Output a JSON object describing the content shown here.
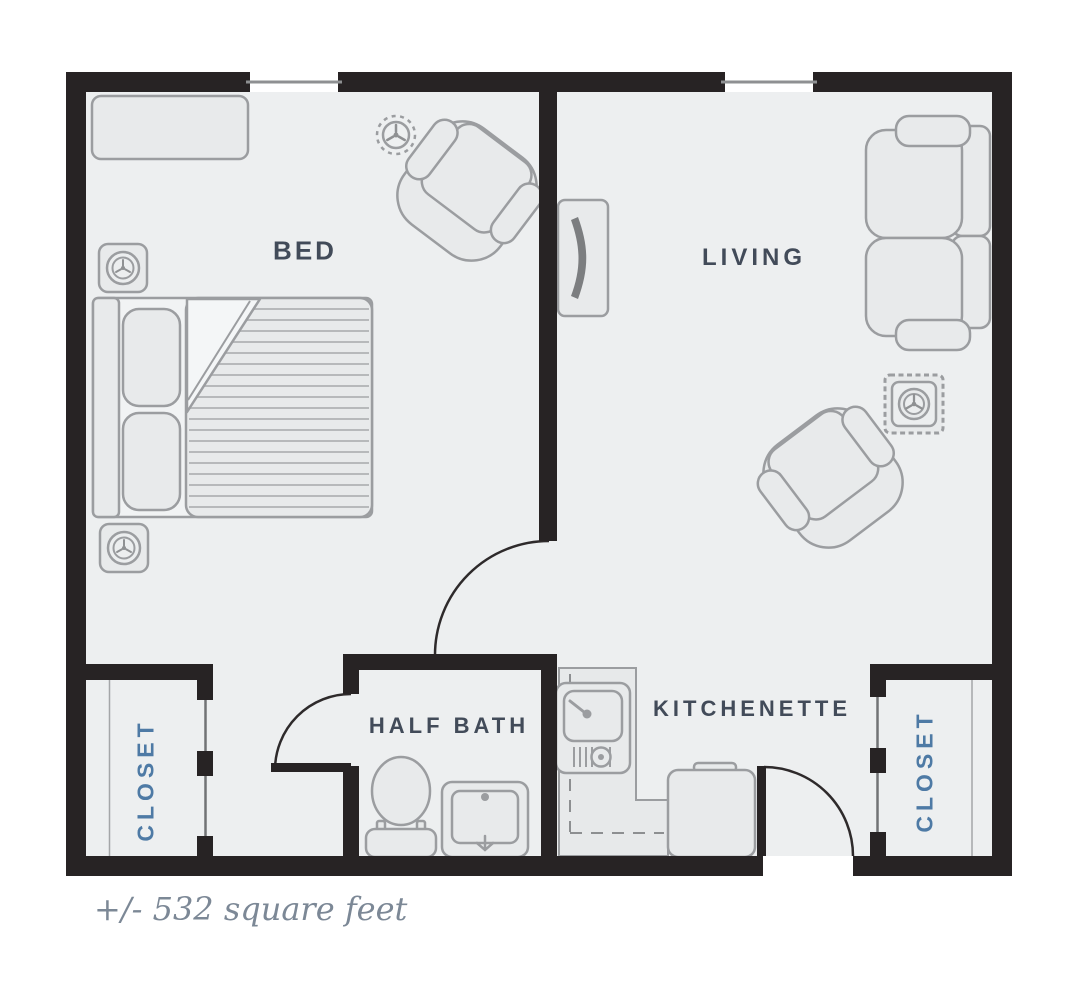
{
  "rooms": {
    "bed": {
      "label": "BED"
    },
    "living": {
      "label": "LIVING"
    },
    "half_bath": {
      "label": "HALF BATH"
    },
    "kitchenette": {
      "label": "KITCHENETTE"
    },
    "closet_left": {
      "label": "CLOSET"
    },
    "closet_right": {
      "label": "CLOSET"
    }
  },
  "area_note": "+/- 532 square feet",
  "fixtures": {
    "bedroom": [
      "dresser",
      "armchair",
      "bed",
      "sprinkler-icon",
      "wall-speaker-icon",
      "wall-speaker-icon"
    ],
    "living": [
      "wall-tv",
      "loveseat-sofa",
      "side-table",
      "armchair"
    ],
    "half_bath": [
      "toilet",
      "bathroom-sink"
    ],
    "kitchenette": [
      "counter",
      "kitchen-sink",
      "mini-fridge"
    ],
    "architecture": [
      "window",
      "window",
      "entry-door",
      "bedroom-door",
      "bath-door",
      "closet-door",
      "closet-door"
    ]
  },
  "colors": {
    "wall": "#272324",
    "floor": "#edeff0",
    "furniture_fill": "#e8eaeb",
    "furniture_stroke": "#9b9da0",
    "label": "#424b59",
    "closet_label": "#4e7aa5",
    "note_text": "#7c8896",
    "window_line": "#8e9092"
  }
}
